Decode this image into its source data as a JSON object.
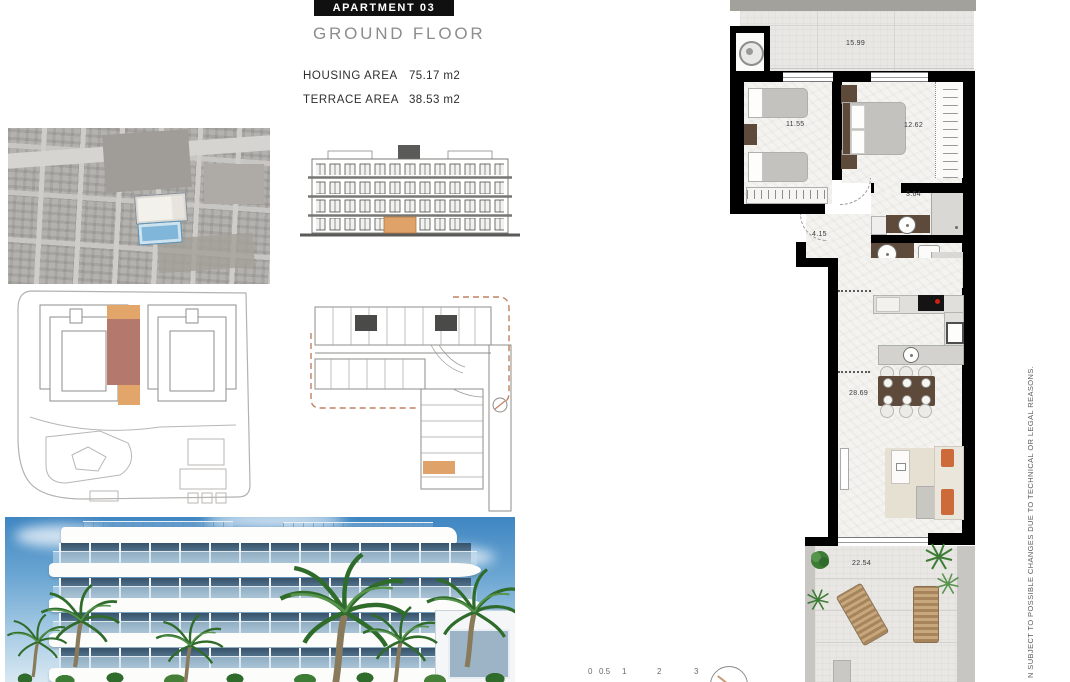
{
  "header": {
    "title": "APARTMENT 03",
    "subtitle": "GROUND FLOOR",
    "areas": [
      {
        "label": "HOUSING AREA",
        "value": "75.17 m2"
      },
      {
        "label": "TERRACE AREA",
        "value": "38.53 m2"
      }
    ]
  },
  "floor_plan": {
    "terrace_top": "15.99",
    "bedroom_1": "11.55",
    "bedroom_2": "12.62",
    "bathroom_1": "3.64",
    "hall": "4.15",
    "bathroom_2": "3.90",
    "living_kitchen": "28.69",
    "terrace_bottom": "22.54"
  },
  "scale_bar": {
    "ticks": [
      "0",
      "0.5",
      "1",
      "2",
      "3"
    ]
  },
  "disclaimer": "N SUBJECT TO POSSIBLE CHANGES DUE TO TECHNICAL OR LEGAL REASONS.",
  "colors": {
    "wall": "#000000",
    "highlight_orange": "#dfa269",
    "highlight_brown": "#b5776b",
    "dashed_outline": "#c08060",
    "cooktop_burner": "#cc2211",
    "pool_blue": "#7fb6d9"
  }
}
